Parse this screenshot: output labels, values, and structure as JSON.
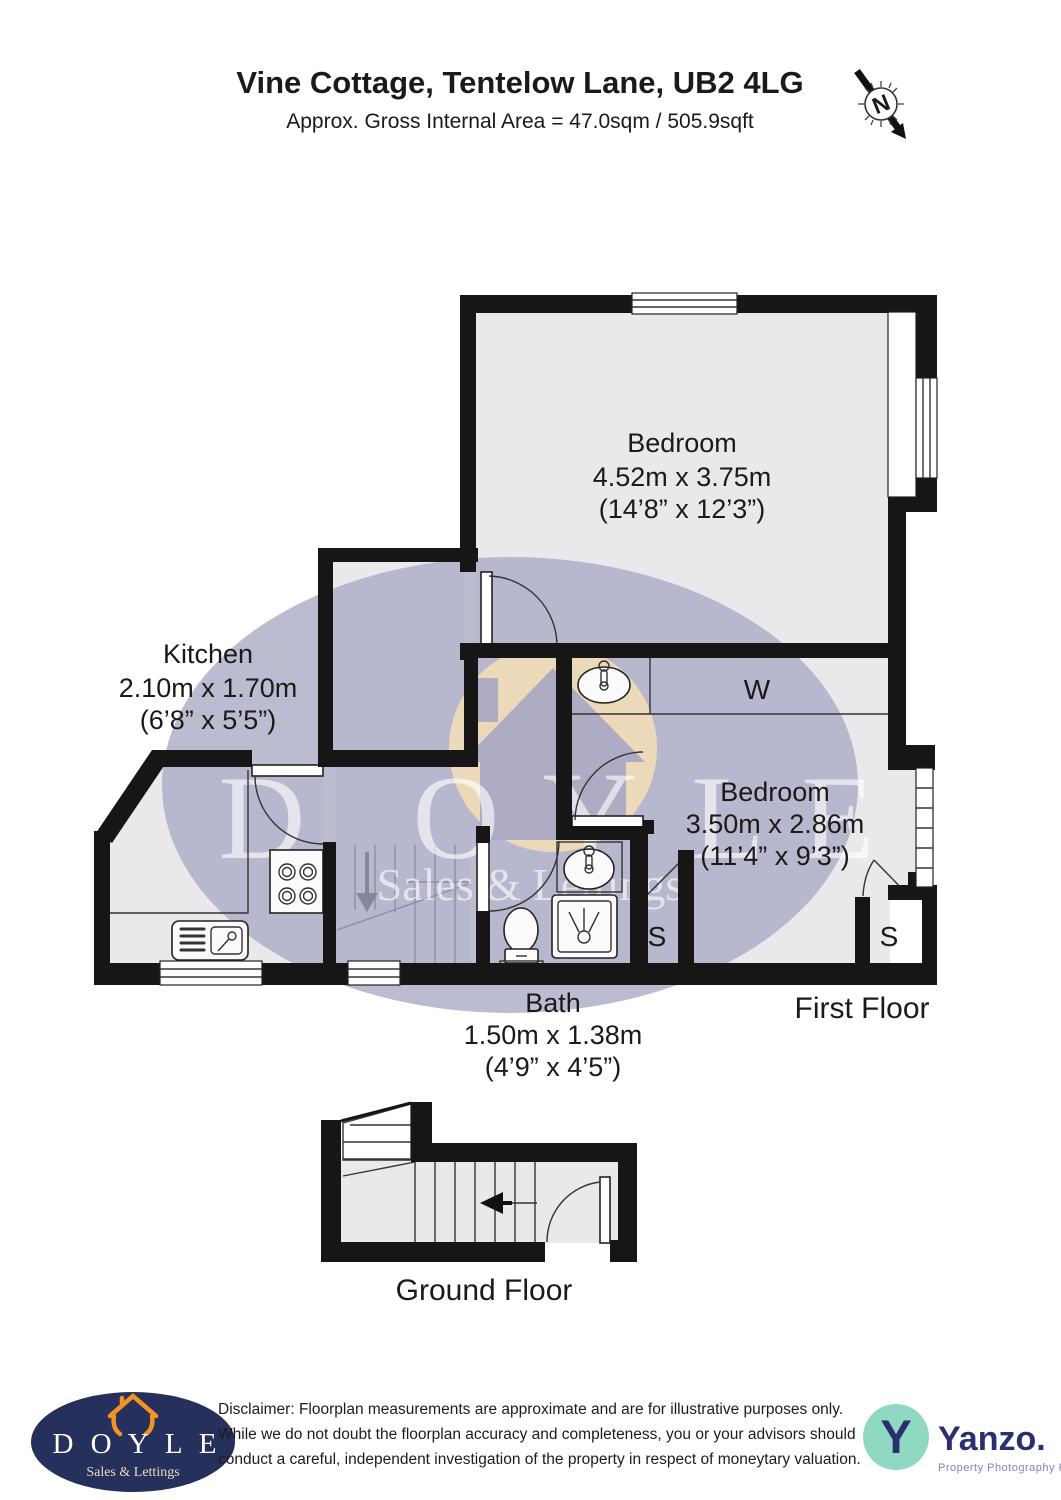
{
  "header": {
    "title": "Vine Cottage, Tentelow Lane, UB2 4LG",
    "subtitle": "Approx. Gross Internal Area = 47.0sqm / 505.9sqft",
    "north_label": "N"
  },
  "rooms": {
    "bedroom1": {
      "label": "Bedroom",
      "metric": "4.52m x 3.75m",
      "imperial": "(14’8” x 12’3”)"
    },
    "kitchen": {
      "label": "Kitchen",
      "metric": "2.10m x 1.70m",
      "imperial": "(6’8” x 5’5”)"
    },
    "bedroom2": {
      "label": "Bedroom",
      "metric": "3.50m x 2.86m",
      "imperial": "(11’4” x 9’3”)"
    },
    "bath": {
      "label": "Bath",
      "metric": "1.50m x 1.38m",
      "imperial": "(4’9” x 4’5”)"
    }
  },
  "labels": {
    "wardrobe": "W",
    "storage": "S",
    "first_floor": "First Floor",
    "ground_floor": "Ground Floor"
  },
  "watermark": {
    "letters": [
      "D",
      "O",
      "Y",
      "L",
      "E"
    ],
    "tagline": "Sales & Lettings"
  },
  "footer": {
    "doyle": {
      "letters": "D O Y L E",
      "tagline": "Sales & Lettings"
    },
    "disclaimer": {
      "line1": "Disclaimer: Floorplan measurements are approximate and are for illustrative purposes only.",
      "line2": "While we do not doubt the floorplan accuracy and completeness, you or your advisors should",
      "line3": "conduct a careful, independent investigation of the property in respect of moneytary valuation."
    },
    "yanzo": {
      "monogram": "Y",
      "name": "Yanzo.",
      "tagline": "Property Photography Reimagined"
    }
  },
  "colors": {
    "wall": "#161616",
    "room_fill": "#e9e9eb",
    "watermark_lavender": "#a9a9c4",
    "watermark_beige": "#f2ddb8",
    "doyle_navy": "#26305c",
    "doyle_orange": "#f39322",
    "yanzo_mint": "#8fd9c2",
    "yanzo_navy": "#2b2f6e",
    "yanzo_purple": "#8a7cc9"
  }
}
